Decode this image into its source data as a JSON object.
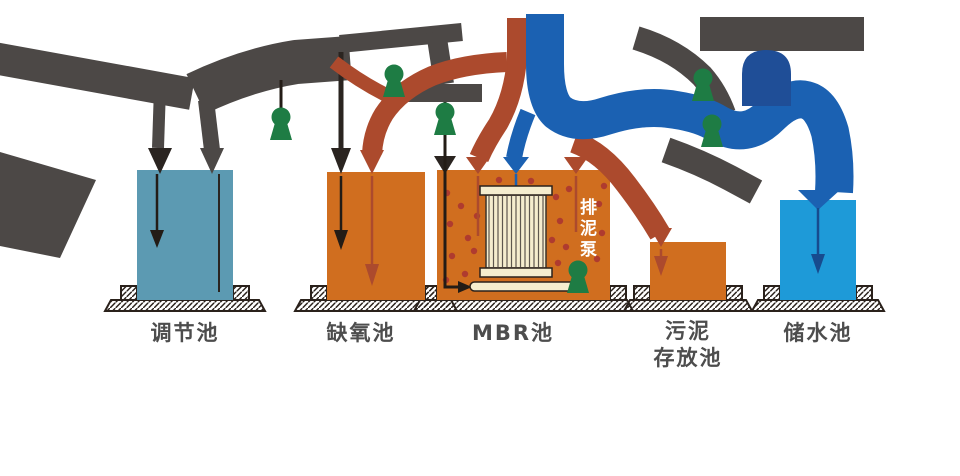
{
  "diagram": {
    "background_color": "#ffffff",
    "tanks": [
      {
        "id": "equalization",
        "label": "调节池",
        "fill": "#5C9AB2"
      },
      {
        "id": "anoxic",
        "label": "缺氧池",
        "fill": "#D06E1F"
      },
      {
        "id": "mbr",
        "label": "MBR池",
        "fill": "#D06E1F"
      },
      {
        "id": "sludge-storage",
        "label": "污泥\n存放池",
        "fill": "#D06E1F"
      },
      {
        "id": "clean-water-storage",
        "label": "储水池",
        "fill": "#1E9AD8"
      }
    ],
    "annotations": {
      "sludge_pump_label": "排泥泵"
    },
    "colors": {
      "pipe_gray": "#4C4846",
      "pipe_red": "#AC4A2D",
      "pipe_blue": "#1B61B2",
      "arch_blue": "#1F4E97",
      "pump_green": "#1E7C44",
      "membrane_cream": "#F5EDCE",
      "dot_red": "#AF3B2F",
      "outline_dark": "#2A211B",
      "label_gray": "#4D4D4D"
    }
  }
}
